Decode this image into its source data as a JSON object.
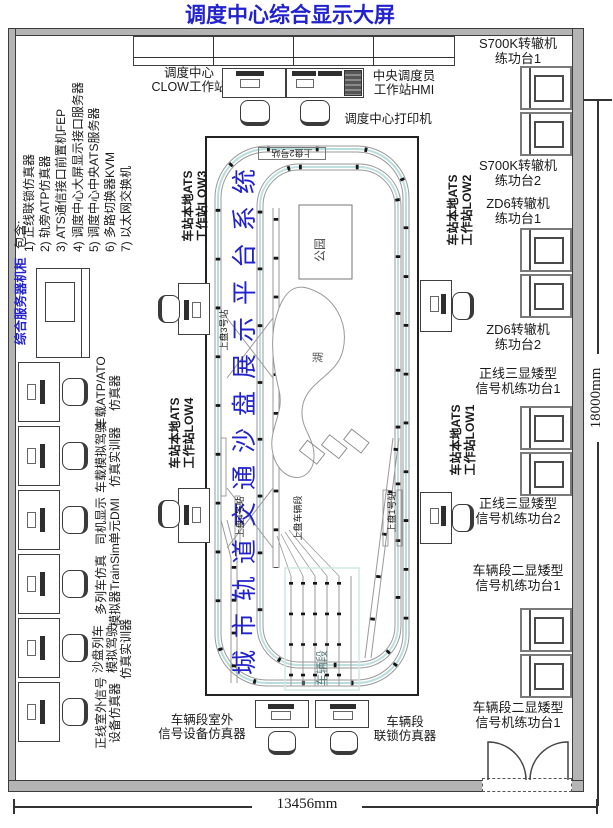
{
  "title": "调度中心综合显示大屏",
  "dimensions": {
    "width": "13456mm",
    "height": "18000mm"
  },
  "server_rack": {
    "label": "综合服务器机柜",
    "contains": "包含:",
    "items": [
      "1) 正线联锁仿真器",
      "2) 轨旁ATP仿真器",
      "3) ATS通信接口前置机FEP",
      "4) 调度中心大屏显示接口服务器",
      "5) 调度中心中央ATS服务器",
      "6) 多路切换器KVM",
      "7) 以太网交换机"
    ]
  },
  "dispatch": {
    "clow": "调度中心\nCLOW工作站",
    "hmi": "中央调度员\n工作站HMI",
    "printer": "调度中心打印机"
  },
  "left_stations": [
    "车载ATP/ATO\n仿真器",
    "车载模拟驾驶\n仿真实训器",
    "司机显示\n单元DMI",
    "多列车仿真\n模拟器TrainSim",
    "沙盘列车\n模拟驾驶\n仿真实训器",
    "正线室外信号\n设备仿真器"
  ],
  "ats": {
    "low1": "车站本地ATS\n工作站LOW1",
    "low2": "车站本地ATS\n工作站LOW2",
    "low3": "车站本地ATS\n工作站LOW3",
    "low4": "车站本地ATS\n工作站LOW4"
  },
  "bottom_stations": {
    "outdoor": "车辆段室外\n信号设备仿真器",
    "interlock": "车辆段\n联锁仿真器"
  },
  "sandtable": {
    "title": "城市轨道交通沙盘展示平台系统",
    "park": "公园",
    "lake": "湖",
    "depot": "车辆段",
    "station1": "上盘1号站",
    "station2": "上盘2号站",
    "station3": "上盘3号站",
    "station4": "上盘4号站",
    "depot_station": "上盘车辆段"
  },
  "right_platforms": [
    "S700K转辙机\n练功台1",
    "S700K转辙机\n练功台2",
    "ZD6转辙机\n练功台1",
    "ZD6转辙机\n练功台2",
    "正线三显矮型\n信号机练功台1",
    "正线三显矮型\n信号机练功台2",
    "车辆段二显矮型\n信号机练功台1",
    "车辆段二显矮型\n信号机练功台1"
  ],
  "colors": {
    "accent_blue": "#2222cc",
    "wall_gray": "#b4b4b4",
    "track_gray": "#999999",
    "track_cyan": "#aad6d4"
  }
}
